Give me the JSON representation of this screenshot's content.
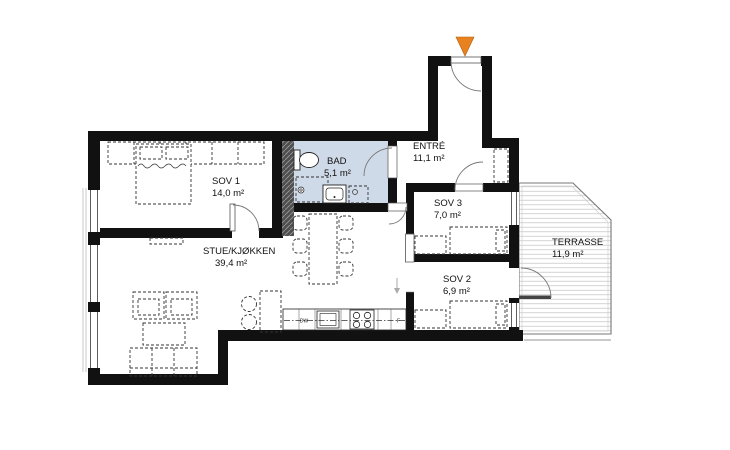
{
  "plan": {
    "rooms": {
      "sov1": {
        "name": "SOV 1",
        "area": "14,0 m²"
      },
      "bad": {
        "name": "BAD",
        "area": "5,1 m²"
      },
      "entre": {
        "name": "ENTRÉ",
        "area": "11,1 m²"
      },
      "sov3": {
        "name": "SOV 3",
        "area": "7,0 m²"
      },
      "sov2": {
        "name": "SOV 2",
        "area": "6,9 m²"
      },
      "stue": {
        "name": "STUE/KJØKKEN",
        "area": "39,4 m²"
      },
      "terrasse": {
        "name": "TERRASSE",
        "area": "11,9 m²"
      }
    },
    "kitchen": {
      "dishwasher": "DW",
      "fridge": "F"
    },
    "colors": {
      "wall": "#111111",
      "bathroom_floor": "#cfdae9",
      "entrance_marker": "#e8821f",
      "terrace_hatch": "#c8c8c8",
      "shaft_fill": "#4f4f4f"
    }
  }
}
